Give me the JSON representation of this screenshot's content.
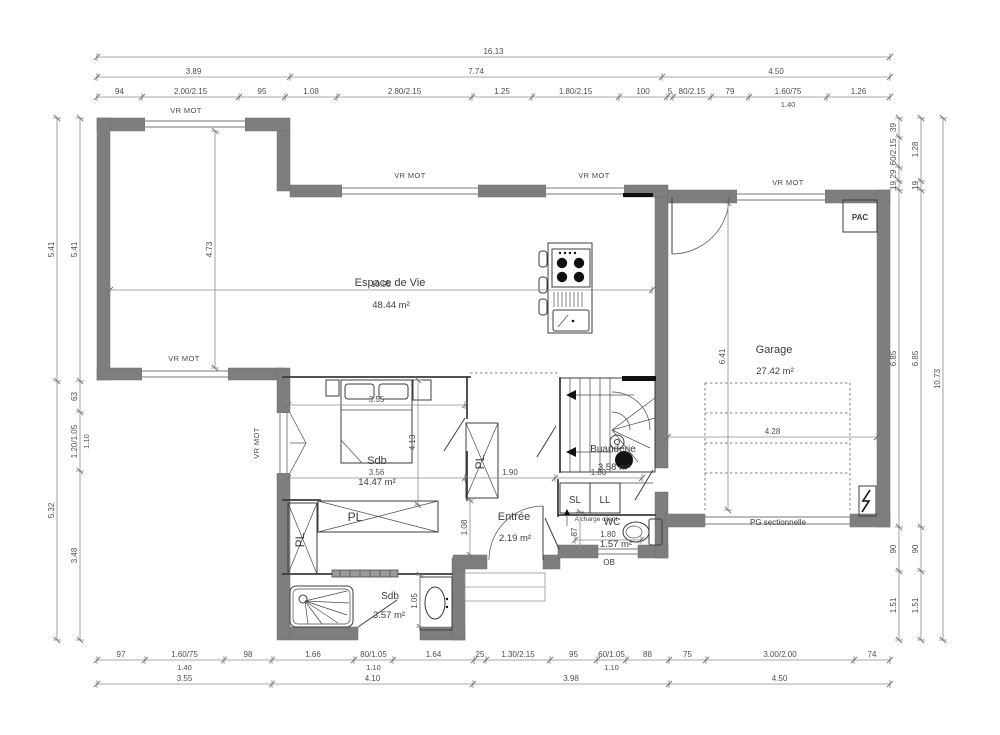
{
  "window_motor_label": "VR MOT",
  "closet_label": "PL",
  "rooms": {
    "living": {
      "name": "Espace de Vie",
      "area": "48.44 m²"
    },
    "garage": {
      "name": "Garage",
      "area": "27.42 m²"
    },
    "bedroom": {
      "name": "Sdb",
      "area": "14.47 m²"
    },
    "entree": {
      "name": "Entrée",
      "area": "2.19 m²"
    },
    "buanderie": {
      "name": "Buanderie",
      "area": "3.58 m²"
    },
    "wc": {
      "name": "WC",
      "area": "1.57 m²"
    },
    "sdb": {
      "name": "Sdb",
      "area": "3.57 m²"
    }
  },
  "equip": {
    "pac": "PAC",
    "sl": "SL",
    "ll": "LL",
    "ob": "OB",
    "pg_door": "PG sectionnelle",
    "client_note": "A charge client"
  },
  "colors": {
    "wall": "#7e7e7e",
    "line": "#3c3c3c",
    "dim_text": "#4f4f4f"
  },
  "dim_chains": [
    {
      "name": "top-total",
      "dir": "h",
      "x": 97,
      "y": 57,
      "segs": [
        {
          "t": "16.13",
          "w": 793
        }
      ]
    },
    {
      "name": "top-groups",
      "dir": "h",
      "x": 97,
      "y": 77,
      "segs": [
        {
          "t": "3.89",
          "w": 193
        },
        {
          "t": "7.74",
          "w": 372
        },
        {
          "t": "4.50",
          "w": 228
        }
      ]
    },
    {
      "name": "top-detail",
      "dir": "h",
      "x": 97,
      "y": 97,
      "segs": [
        {
          "t": "94",
          "w": 45
        },
        {
          "t": "2.00/2.15",
          "w": 97
        },
        {
          "t": "95",
          "w": 46
        },
        {
          "t": "1.08",
          "w": 52
        },
        {
          "t": "2.80/2.15",
          "w": 135
        },
        {
          "t": "1.25",
          "w": 60
        },
        {
          "t": "1.80/2.15",
          "w": 87
        },
        {
          "t": "100",
          "w": 48
        },
        {
          "t": "5",
          "w": 6
        },
        {
          "t": "80/2.15",
          "w": 38
        },
        {
          "t": "79",
          "w": 38
        },
        {
          "t": "1.60/75",
          "w": 78,
          "sub": "1.40"
        },
        {
          "t": "1.26",
          "w": 63
        }
      ]
    },
    {
      "name": "bottom-detail",
      "dir": "h",
      "x": 97,
      "y": 660,
      "segs": [
        {
          "t": "97",
          "w": 48
        },
        {
          "t": "1.60/75",
          "w": 79,
          "sub": "1.40"
        },
        {
          "t": "98",
          "w": 48
        },
        {
          "t": "1.66",
          "w": 82
        },
        {
          "t": "80/1.05",
          "w": 39,
          "sub": "1.10"
        },
        {
          "t": "1.64",
          "w": 81
        },
        {
          "t": "25",
          "w": 12
        },
        {
          "t": "1.30/2.15",
          "w": 64
        },
        {
          "t": "95",
          "w": 47
        },
        {
          "t": "60/1.05",
          "w": 29,
          "sub": "1.10"
        },
        {
          "t": "88",
          "w": 43
        },
        {
          "t": "75",
          "w": 37
        },
        {
          "t": "3.00/2.00",
          "w": 148
        },
        {
          "t": "74",
          "w": 36
        }
      ]
    },
    {
      "name": "bottom-groups",
      "dir": "h",
      "x": 97,
      "y": 684,
      "segs": [
        {
          "t": "3.55",
          "w": 175
        },
        {
          "t": "4.10",
          "w": 201
        },
        {
          "t": "3.98",
          "w": 196
        },
        {
          "t": "4.50",
          "w": 221
        }
      ]
    },
    {
      "name": "left-outer",
      "dir": "v",
      "x": 57,
      "y": 118,
      "segs": [
        {
          "t": "5.41",
          "w": 263
        },
        {
          "t": "5.32",
          "w": 259
        }
      ]
    },
    {
      "name": "left-inner",
      "dir": "v",
      "x": 80,
      "y": 118,
      "segs": [
        {
          "t": "5.41",
          "w": 263
        },
        {
          "t": "63",
          "w": 31
        },
        {
          "t": "1.20/1.05",
          "w": 59,
          "sub": "1.10"
        },
        {
          "t": "3.48",
          "w": 169
        }
      ]
    },
    {
      "name": "right-inner",
      "dir": "v",
      "x": 899,
      "y": 118,
      "segs": [
        {
          "t": "39",
          "w": 19
        },
        {
          "t": "60/2.15",
          "w": 30
        },
        {
          "t": "29",
          "w": 14
        },
        {
          "t": "19",
          "w": 9
        },
        {
          "t": "6.85",
          "w": 337
        },
        {
          "t": "90",
          "w": 44
        },
        {
          "t": "1.51",
          "w": 69
        }
      ]
    },
    {
      "name": "right-mid",
      "dir": "v",
      "x": 921,
      "y": 118,
      "segs": [
        {
          "t": "1.28",
          "w": 63
        },
        {
          "t": "19",
          "w": 9
        },
        {
          "t": "6.85",
          "w": 337
        },
        {
          "t": "90",
          "w": 44
        },
        {
          "t": "1.51",
          "w": 69
        }
      ]
    },
    {
      "name": "right-outer",
      "dir": "v",
      "x": 943,
      "y": 118,
      "segs": [
        {
          "t": "10.73",
          "w": 522
        }
      ]
    },
    {
      "name": "living-width",
      "dir": "h",
      "x": 110,
      "y": 290,
      "segs": [
        {
          "t": "10.95",
          "w": 542
        }
      ]
    },
    {
      "name": "living-height",
      "dir": "v",
      "x": 215,
      "y": 131,
      "segs": [
        {
          "t": "4.73",
          "w": 237
        }
      ]
    },
    {
      "name": "garage-width",
      "dir": "h",
      "x": 668,
      "y": 437,
      "segs": [
        {
          "t": "4.28",
          "w": 209
        }
      ]
    },
    {
      "name": "garage-height",
      "dir": "v",
      "x": 728,
      "y": 203,
      "segs": [
        {
          "t": "6.41",
          "w": 307
        }
      ]
    },
    {
      "name": "bed-width",
      "dir": "h",
      "x": 288,
      "y": 405,
      "segs": [
        {
          "t": "3.55",
          "w": 177
        }
      ]
    },
    {
      "name": "mid-width",
      "dir": "h",
      "x": 288,
      "y": 478,
      "segs": [
        {
          "t": "3.56",
          "w": 177
        },
        {
          "t": "1.90",
          "w": 90
        },
        {
          "t": "1.80",
          "w": 87
        }
      ]
    },
    {
      "name": "bed-height",
      "dir": "v",
      "x": 418,
      "y": 380,
      "segs": [
        {
          "t": "4.13",
          "w": 125
        }
      ]
    },
    {
      "name": "entree-height",
      "dir": "v",
      "x": 470,
      "y": 500,
      "segs": [
        {
          "t": "1.08",
          "w": 55
        }
      ]
    },
    {
      "name": "wc-height",
      "dir": "v",
      "x": 580,
      "y": 512,
      "segs": [
        {
          "t": "87",
          "w": 40
        }
      ]
    },
    {
      "name": "wc-width",
      "dir": "h",
      "x": 575,
      "y": 540,
      "segs": [
        {
          "t": "1.80",
          "w": 66
        }
      ]
    },
    {
      "name": "sdb-height",
      "dir": "v",
      "x": 420,
      "y": 575,
      "segs": [
        {
          "t": "1.05",
          "w": 52
        }
      ]
    }
  ]
}
